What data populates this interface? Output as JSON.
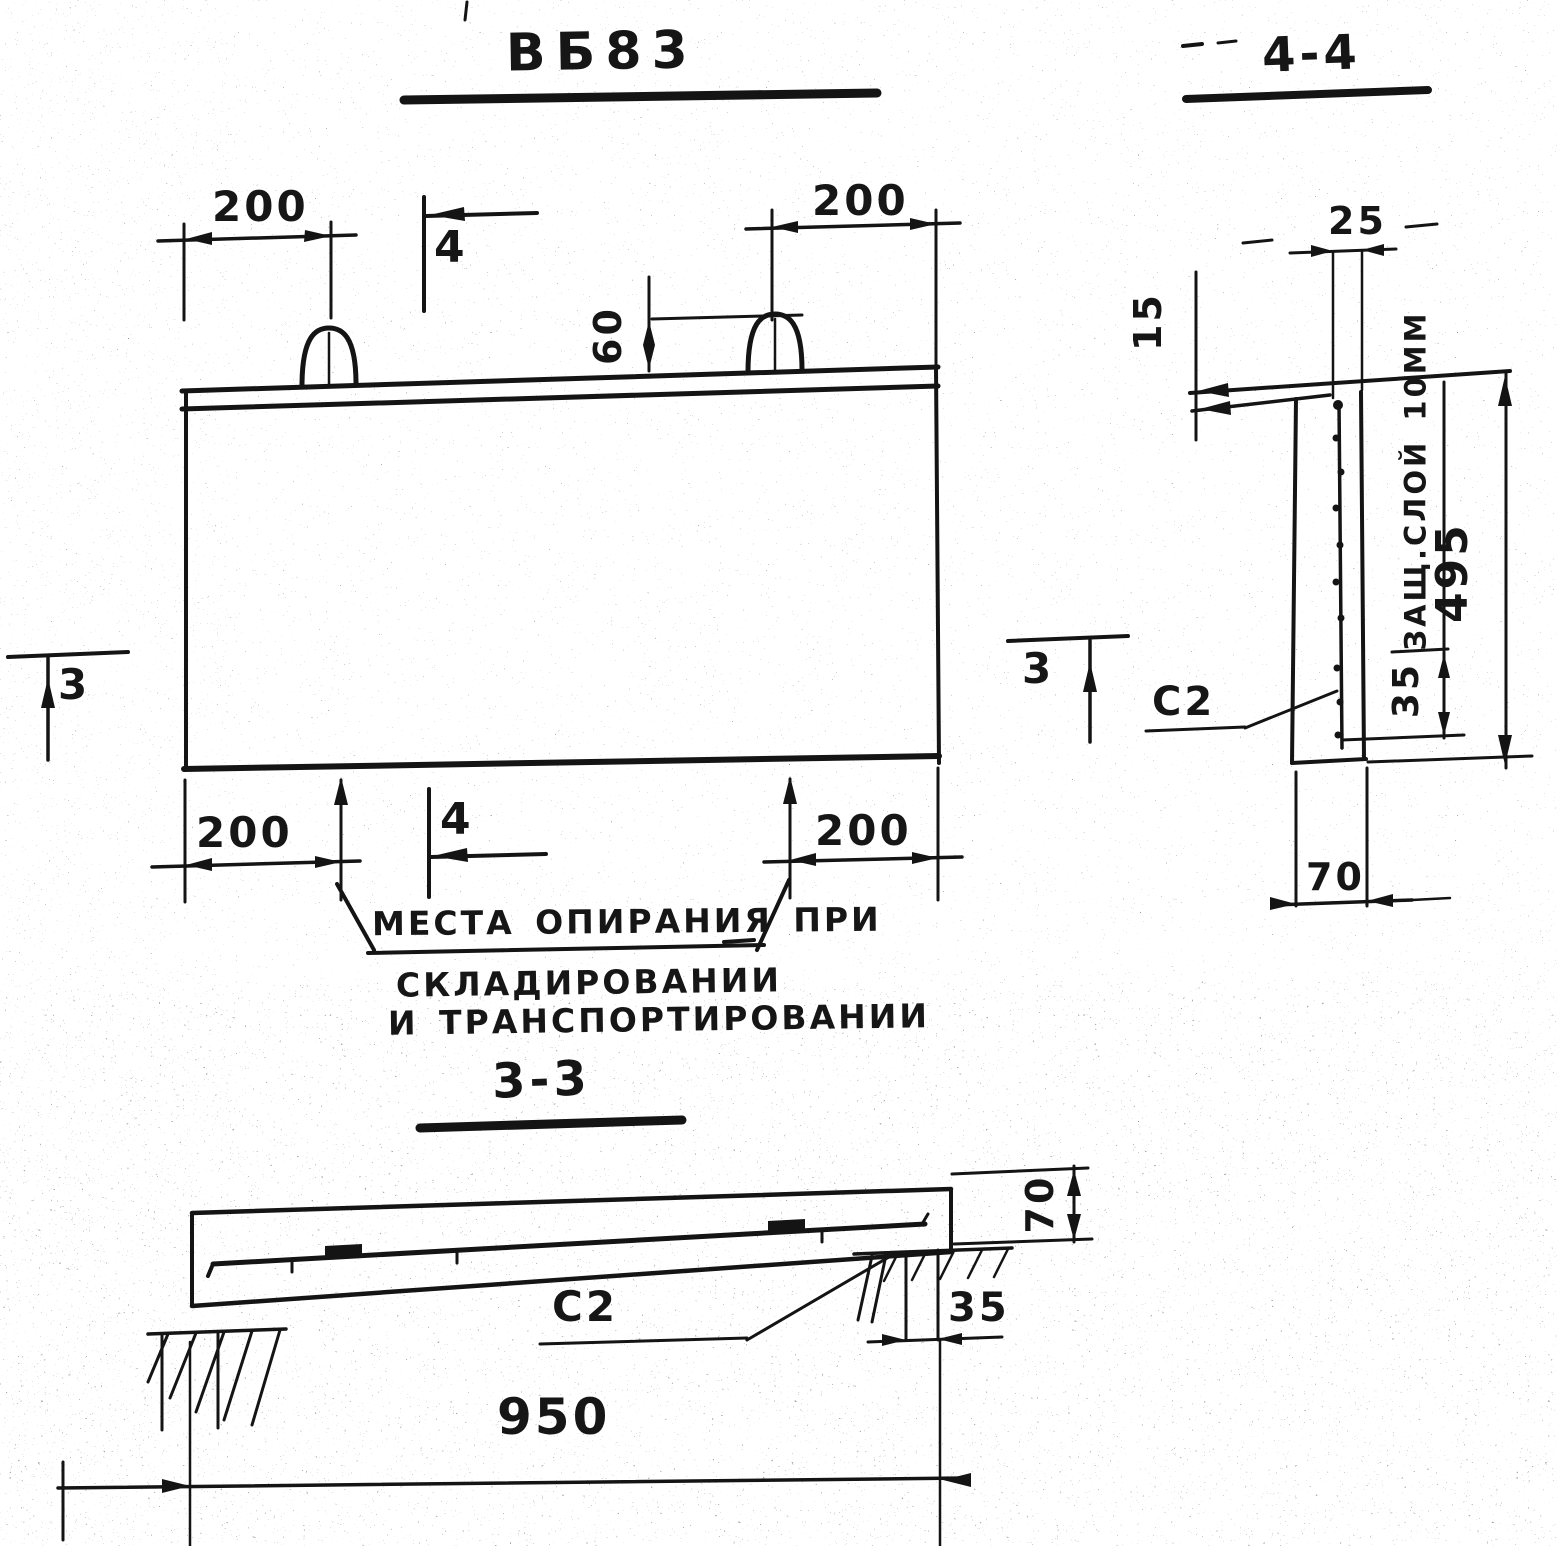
{
  "title": {
    "main": "ВБ83",
    "section44": "4-4",
    "section33": "3-3"
  },
  "elevation": {
    "dims": {
      "top_left": "200",
      "top_right": "200",
      "loop_height": "60",
      "bottom_left": "200",
      "bottom_right": "200"
    },
    "cuts": {
      "four": "4",
      "three": "3"
    },
    "note": {
      "line1": "МЕСТА ОПИРАНИЯ ПРИ",
      "line2": "СКЛАДИРОВАНИИ",
      "line3": "И ТРАНСПОРТИРОВАНИИ"
    }
  },
  "section44": {
    "dims": {
      "d25": "25",
      "d15": "15",
      "d495": "495",
      "d35": "35",
      "d70": "70"
    },
    "cover_note": "ЗАЩ.СЛОЙ 10ММ",
    "mesh_label": "С2"
  },
  "section33": {
    "dims": {
      "d70": "70",
      "d35": "35",
      "d950": "950"
    },
    "mesh_label": "С2"
  },
  "colors": {
    "ink": "#141414",
    "paper": "#ffffff"
  }
}
